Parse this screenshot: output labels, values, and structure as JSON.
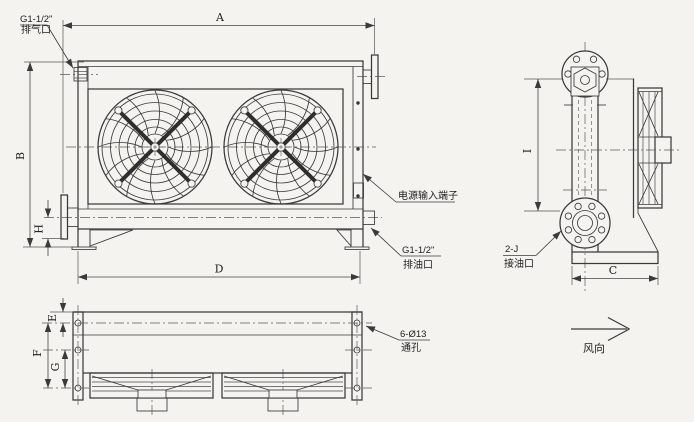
{
  "page": {
    "background": "#f4f3ef"
  },
  "colors": {
    "line": "#3a3a3a",
    "dimension": "#444444",
    "text": "#1e1e1e"
  },
  "labels": {
    "a": "A",
    "b": "B",
    "c": "C",
    "d": "D",
    "e": "E",
    "f": "F",
    "g": "G",
    "h": "H",
    "i": "I"
  },
  "callouts": {
    "vent_port": {
      "spec": "G1-1/2\"",
      "name": "排气口"
    },
    "power_terminal": {
      "name": "电源输入端子"
    },
    "drain_port": {
      "spec": "G1-1/2\"",
      "name": "排油口"
    },
    "oil_ports": {
      "spec": "2-J",
      "name": "接油口"
    },
    "mounting_holes": {
      "spec": "6-Ø13",
      "name": "通孔"
    },
    "air_flow": {
      "name": "风向"
    }
  }
}
